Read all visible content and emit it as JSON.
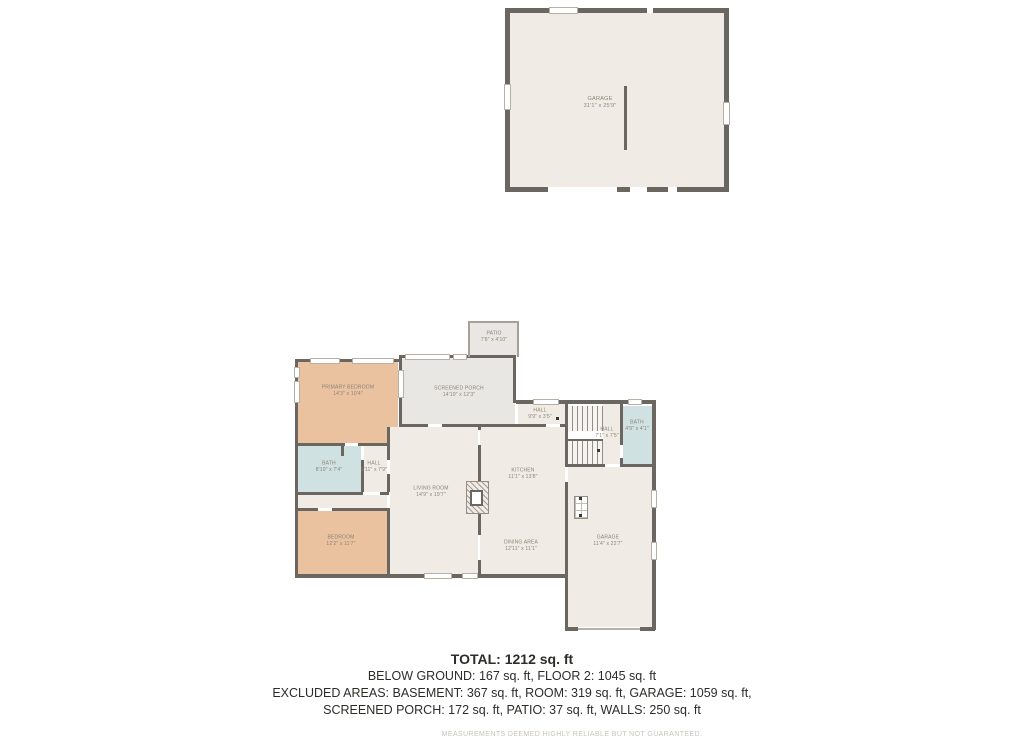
{
  "colors": {
    "wall": "#6b6660",
    "beige": "#f0ece5",
    "salmon": "#eac2a0",
    "blue": "#cfe1e0",
    "gray": "#e9e7e3",
    "labelc": "#8c8376"
  },
  "floor2": {
    "garage": {
      "name": "GARAGE",
      "dims": "31'1\" x 25'9\""
    }
  },
  "floor1": {
    "rooms": [
      {
        "id": "patio",
        "name": "PATIO",
        "dims": "7'8\" x 4'10\""
      },
      {
        "id": "screened-porch",
        "name": "SCREENED PORCH",
        "dims": "14'10\" x 12'3\""
      },
      {
        "id": "primary-bedroom",
        "name": "PRIMARY BEDROOM",
        "dims": "14'3\" x 10'4\""
      },
      {
        "id": "hall-upper",
        "name": "HALL",
        "dims": "9'9\" x 3'5\""
      },
      {
        "id": "hall-stairs",
        "name": "HALL",
        "dims": "7'1\" x 7'5\""
      },
      {
        "id": "bath-upper",
        "name": "BATH",
        "dims": "4'9\" x 4'1\""
      },
      {
        "id": "bath-left",
        "name": "BATH",
        "dims": "8'10\" x 7'4\""
      },
      {
        "id": "hall-left",
        "name": "HALL",
        "dims": "2'11\" x 7'9\""
      },
      {
        "id": "living-room",
        "name": "LIVING ROOM",
        "dims": "14'9\" x 19'7\""
      },
      {
        "id": "bedroom",
        "name": "BEDROOM",
        "dims": "12'2\" x 11'7\""
      },
      {
        "id": "kitchen",
        "name": "KITCHEN",
        "dims": "11'1\" x 13'8\""
      },
      {
        "id": "dining-area",
        "name": "DINING AREA",
        "dims": "12'11\" x 11'1\""
      },
      {
        "id": "garage",
        "name": "GARAGE",
        "dims": "11'4\" x 22'7\""
      }
    ]
  },
  "summary": {
    "total": "TOTAL: 1212 sq. ft",
    "line1": "BELOW GROUND: 167 sq. ft, FLOOR 2: 1045 sq. ft",
    "line2": "EXCLUDED AREAS: BASEMENT: 367 sq. ft, ROOM: 319 sq. ft, GARAGE: 1059 sq. ft,",
    "line3": "SCREENED PORCH: 172 sq. ft, PATIO: 37 sq. ft, WALLS: 250 sq. ft",
    "disclaimer": "MEASUREMENTS DEEMED HIGHLY RELIABLE BUT NOT GUARANTEED."
  }
}
